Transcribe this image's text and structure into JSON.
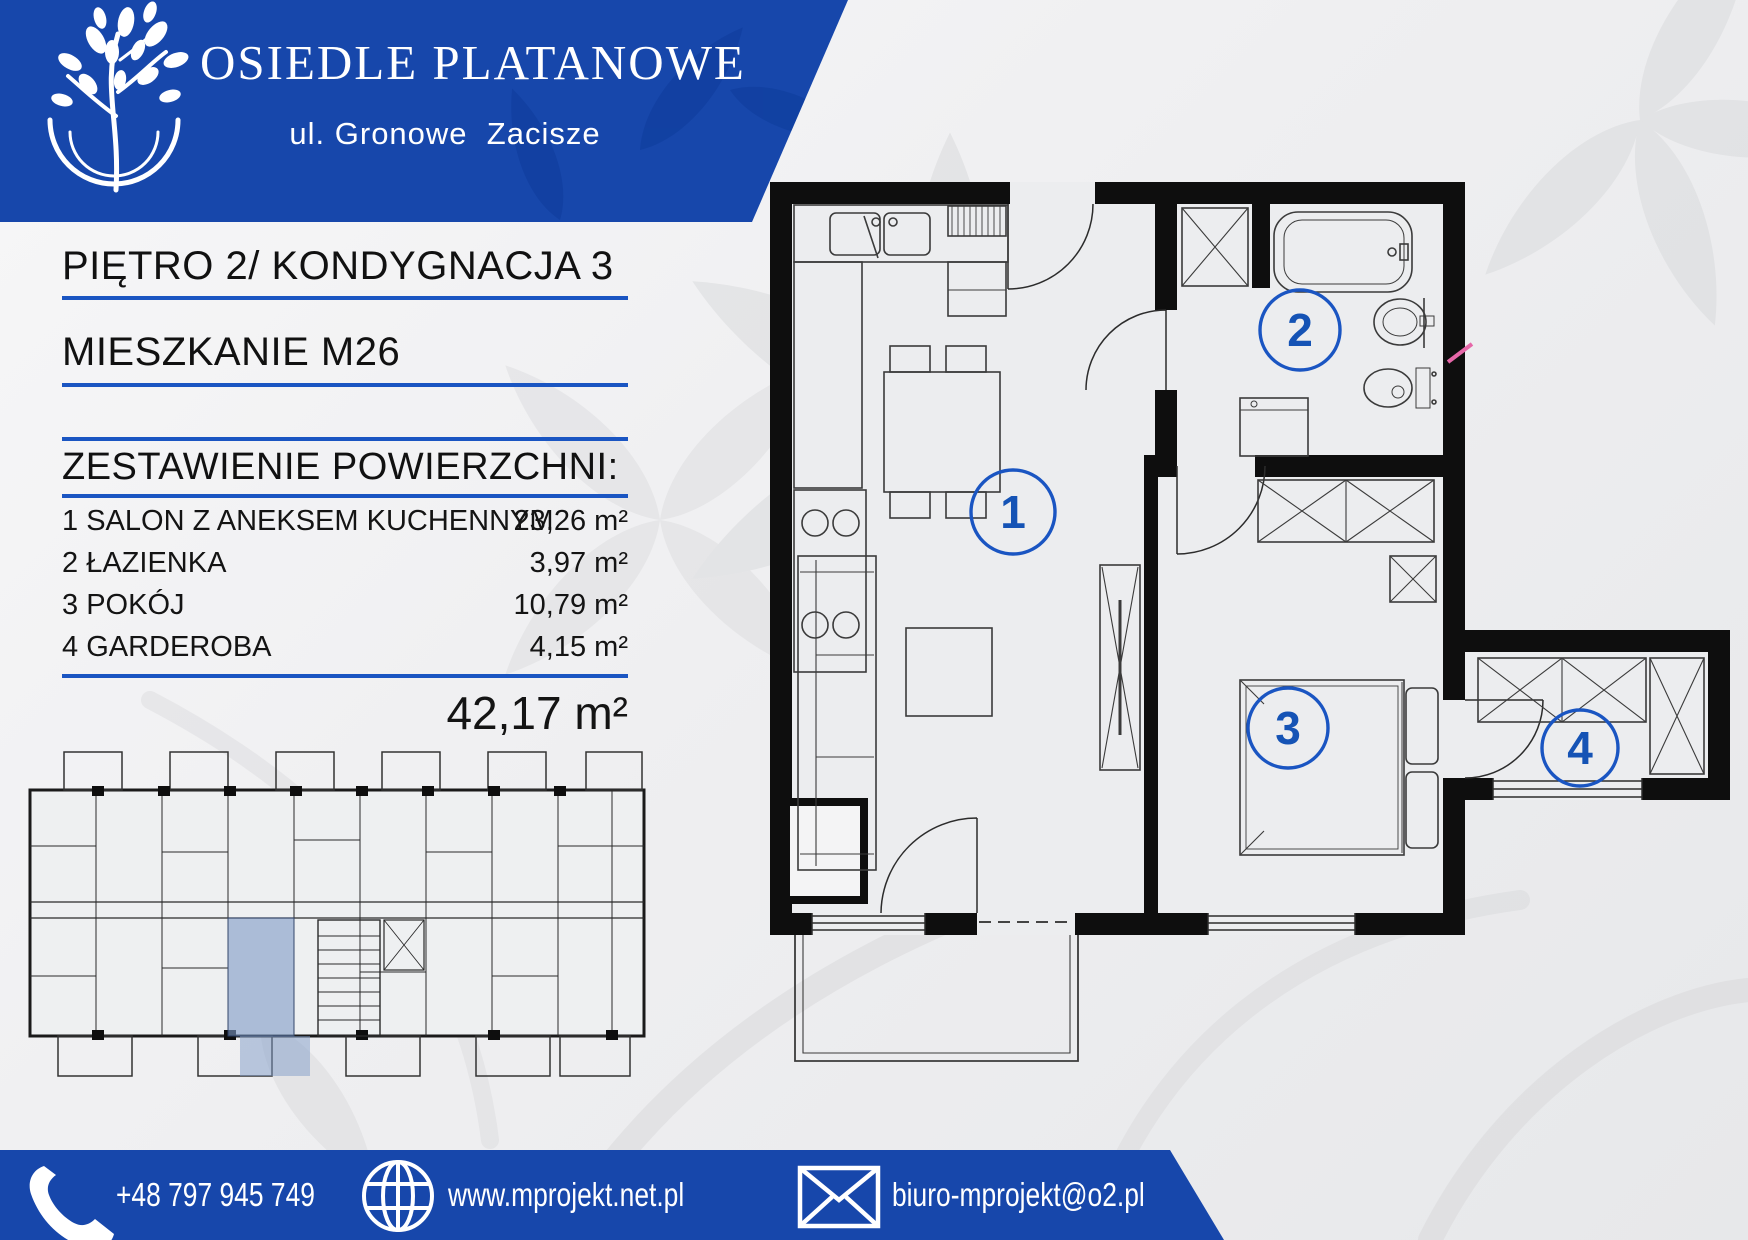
{
  "header": {
    "title": "OSIEDLE PLATANOWE",
    "subtitle": "ul. Gronowe  Zacisze"
  },
  "info": {
    "floor_line": "PIĘTRO 2/ KONDYGNACJA 3",
    "unit_line": "MIESZKANIE M26",
    "section_title": "ZESTAWIENIE POWIERZCHNI:",
    "rooms": [
      {
        "num": "1",
        "name": "SALON Z ANEKSEM KUCHENNYM",
        "area": "23,26 m²"
      },
      {
        "num": "2",
        "name": "ŁAZIENKA",
        "area": "3,97 m²"
      },
      {
        "num": "3",
        "name": "POKÓJ",
        "area": "10,79 m²"
      },
      {
        "num": "4",
        "name": "GARDEROBA",
        "area": "4,15 m²"
      }
    ],
    "total_area": "42,17 m²"
  },
  "plan": {
    "labels": [
      "1",
      "2",
      "3",
      "4"
    ]
  },
  "footer": {
    "phone": "+48 797 945 749",
    "website": "www.mprojekt.net.pl",
    "email": "biuro-mprojekt@o2.pl"
  },
  "colors": {
    "brand_blue": "#1747ab",
    "line_blue": "#1a55c2",
    "number_blue": "#1553b5",
    "highlight_unit": "#7f9bc7",
    "watermark_gray": "#d7d8da",
    "annotation_pink": "#e667a8"
  }
}
